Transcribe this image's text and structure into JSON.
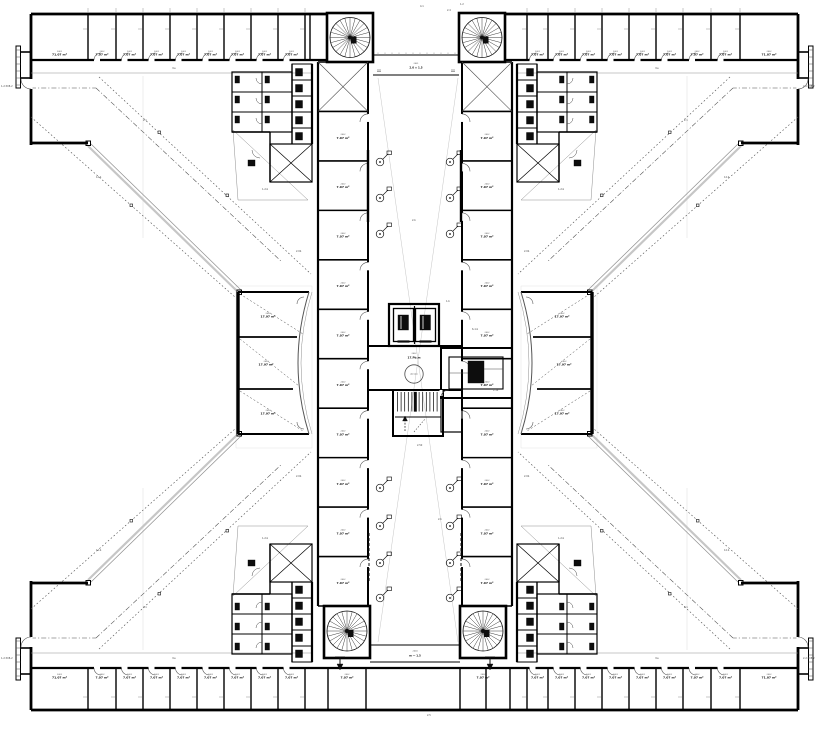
{
  "canvas": {
    "width": 833,
    "height": 732,
    "bg": "#ffffff"
  },
  "colors": {
    "ink": "#0d0d0d",
    "wall": "#000000",
    "mid": "#4a4a4a",
    "gray": "#8f8f8f",
    "light": "#c6c6c6",
    "faint": "#d9d9d9",
    "label_no": "#5a5a5a"
  },
  "plan": {
    "name": "x-plan-office-floor",
    "room_no": "2402",
    "room_area": "7.07 m²",
    "corner_room_area": "71.07 m²",
    "mid_room_area": "17.97 m²",
    "counts": {
      "top_band_left": 9,
      "top_band_right": 9,
      "bottom_band_left": 9,
      "bottom_band_right": 9,
      "left_column": 11,
      "right_column": 11,
      "mid_left": 3,
      "mid_right": 3
    },
    "core": {
      "lobby_no": "2402",
      "lobby_name": "17.Pb.m",
      "turning_circle": "Ø1500",
      "plant_no": "2403",
      "plant_area": "1.14 m²",
      "stair_mark": "2.50"
    },
    "bridge_top": {
      "no": "2401",
      "size": "2.0 × 1.5"
    },
    "bridge_bottom": {
      "no": "2404",
      "size": "m — 1.5"
    }
  },
  "annotations": [
    {
      "x": 420,
      "y": 7,
      "t": "4.1"
    },
    {
      "x": 447,
      "y": 11,
      "t": "2.4"
    },
    {
      "x": 460,
      "y": 5,
      "t": "1.2"
    },
    {
      "x": 172,
      "y": 69,
      "t": "ms"
    },
    {
      "x": 655,
      "y": 69,
      "t": "ms"
    },
    {
      "x": 172,
      "y": 659,
      "t": "ms"
    },
    {
      "x": 655,
      "y": 659,
      "t": "ms"
    },
    {
      "x": 143,
      "y": 121,
      "t": "2.1"
    },
    {
      "x": 684,
      "y": 121,
      "t": "2.1"
    },
    {
      "x": 143,
      "y": 608,
      "t": "2.1"
    },
    {
      "x": 684,
      "y": 608,
      "t": "2.1"
    },
    {
      "x": 96,
      "y": 178,
      "t": "12.b"
    },
    {
      "x": 724,
      "y": 178,
      "t": "12.b"
    },
    {
      "x": 96,
      "y": 551,
      "t": "12.b"
    },
    {
      "x": 724,
      "y": 551,
      "t": "12.b"
    },
    {
      "x": 262,
      "y": 190,
      "t": "1-2.b"
    },
    {
      "x": 558,
      "y": 190,
      "t": "1-2.b"
    },
    {
      "x": 262,
      "y": 539,
      "t": "1-2.b"
    },
    {
      "x": 558,
      "y": 539,
      "t": "1-2.b"
    },
    {
      "x": 296,
      "y": 252,
      "t": "2.0b"
    },
    {
      "x": 524,
      "y": 252,
      "t": "2.0b"
    },
    {
      "x": 296,
      "y": 477,
      "t": "2.0b"
    },
    {
      "x": 524,
      "y": 477,
      "t": "2.0b"
    },
    {
      "x": 1,
      "y": 87,
      "t": "1-2.508-2"
    },
    {
      "x": 1,
      "y": 659,
      "t": "1-2.508-2"
    },
    {
      "x": 803,
      "y": 87,
      "t": "2-2.508-2"
    },
    {
      "x": 803,
      "y": 659,
      "t": "2-2.508-2"
    },
    {
      "x": 412,
      "y": 221,
      "t": "2.b"
    },
    {
      "x": 438,
      "y": 520,
      "t": "2.b"
    },
    {
      "x": 427,
      "y": 716,
      "t": "2.5"
    },
    {
      "x": 446,
      "y": 302,
      "t": "1.b"
    },
    {
      "x": 493,
      "y": 391,
      "t": "1.14"
    },
    {
      "x": 472,
      "y": 330,
      "t": "6-1.b"
    },
    {
      "x": 417,
      "y": 446,
      "t": "2.50"
    }
  ]
}
